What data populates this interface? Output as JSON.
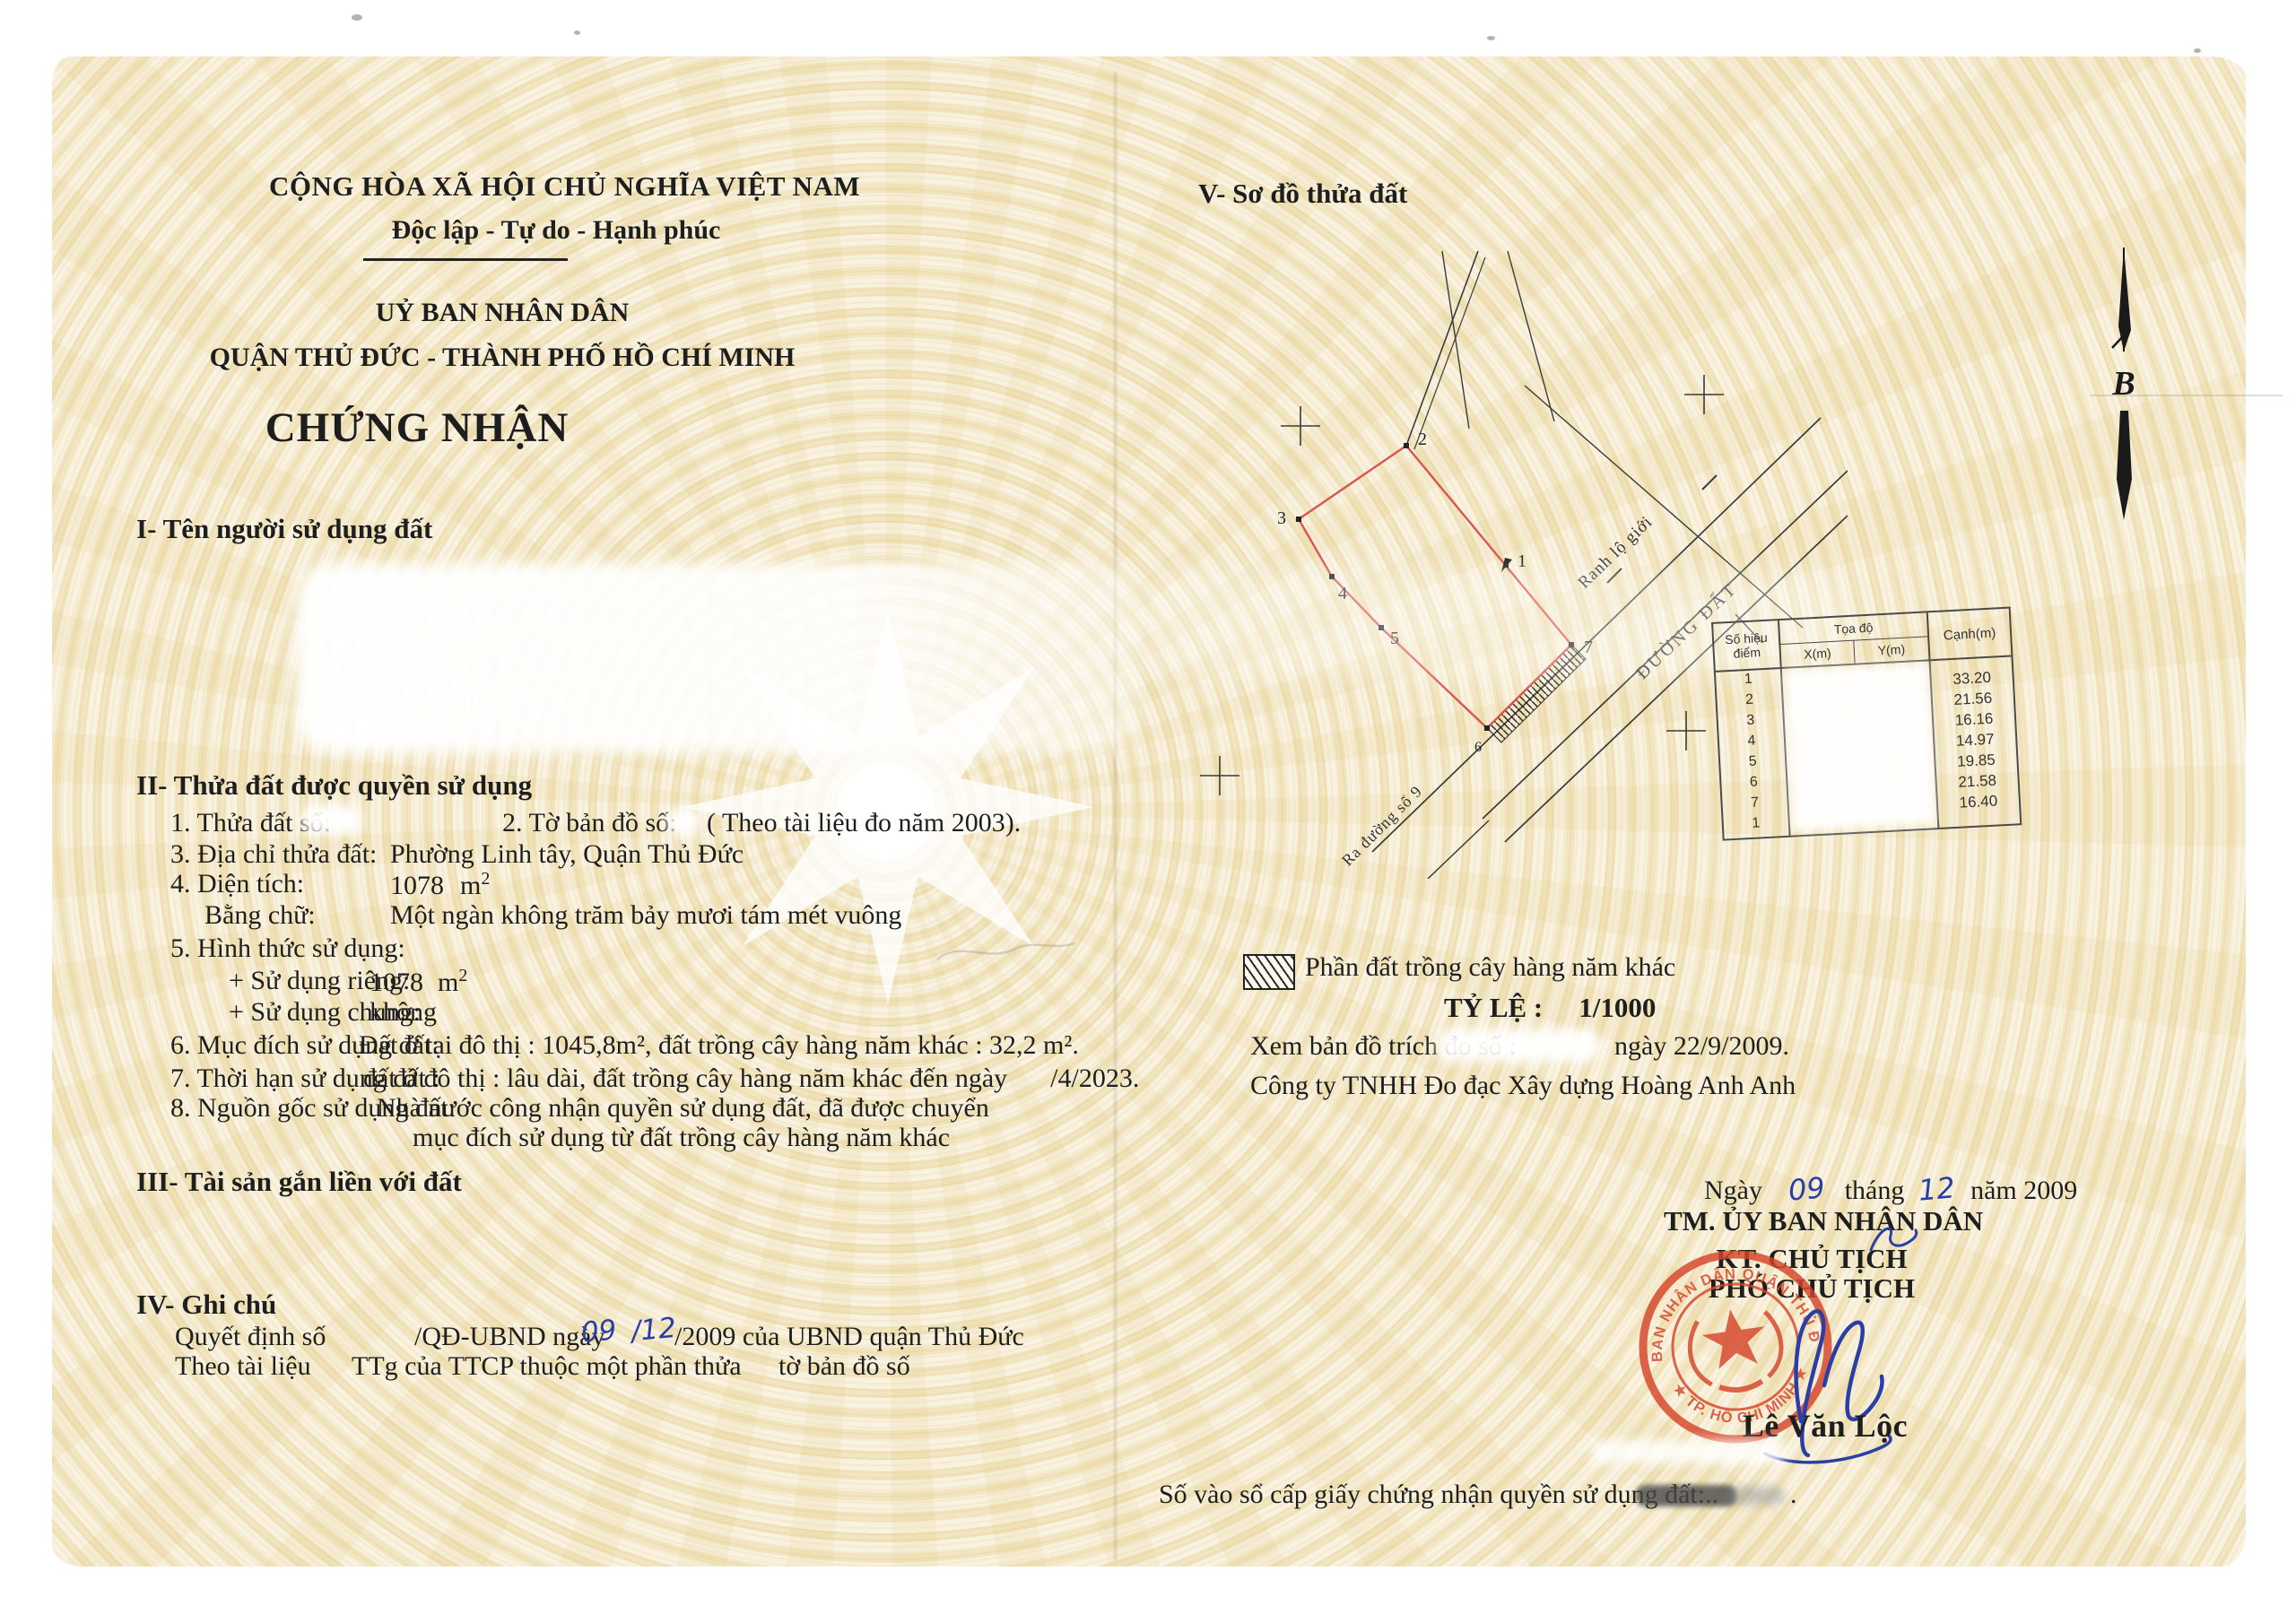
{
  "header": {
    "national_title": "CỘNG HÒA XÃ HỘI CHỦ NGHĨA VIỆT NAM",
    "motto": "Độc lập - Tự do - Hạnh phúc",
    "issuer_line1": "UỶ BAN NHÂN DÂN",
    "issuer_line2": "QUẬN THỦ ĐỨC - THÀNH PHỐ HỒ CHÍ MINH",
    "doc_title": "CHỨNG NHẬN"
  },
  "section1": {
    "heading": "I- Tên người sử dụng đất"
  },
  "section2": {
    "heading": "II- Thửa đất được quyền sử dụng",
    "item1_label": "1. Thửa đất số:",
    "item2_label": "2. Tờ bản đồ số:",
    "item2_note": "( Theo tài liệu đo năm 2003).",
    "item3_label": "3. Địa chỉ thửa đất:",
    "item3_value": "Phường Linh tây, Quận Thủ Đức",
    "item4_label": "4. Diện tích:",
    "item4_value": "1078",
    "item4_unit": "m",
    "item4_sup": "2",
    "words_label": "Bằng chữ:",
    "words_value": "Một ngàn không trăm bảy mươi tám mét vuông",
    "item5_label": "5. Hình thức sử dụng:",
    "private_label": "+ Sử dụng riêng:",
    "private_value": "1078",
    "private_unit": "m",
    "private_sup": "2",
    "shared_label": "+ Sử dụng chung:",
    "shared_value": "không",
    "item6_label": "6. Mục đích sử dụng đất:",
    "item6_value": "Đất ở tại đô thị : 1045,8m², đất trồng cây hàng năm khác : 32,2 m².",
    "item7_label": "7. Thời hạn sử dụng đất :",
    "item7_value": "đất ở đô thị : lâu dài, đất trồng cây hàng năm khác đến ngày",
    "item7_date": "/4/2023.",
    "item8_label": "8. Nguồn gốc sử dụng đất:",
    "item8_value": "Nhà nước công nhận quyền sử dụng đất, đã được chuyển",
    "item8_cont": "mục đích sử dụng từ đất trồng cây hàng năm khác"
  },
  "section3": {
    "heading": "III- Tài sản gắn liền với đất"
  },
  "section4": {
    "heading": "IV- Ghi chú",
    "line1_pre": "Quyết định số",
    "line1_mid": "/QĐ-UBND ngày",
    "line1_day": "09",
    "line1_month": "/12",
    "line1_post": "/2009 của UBND quận Thủ Đức",
    "line2_pre": "Theo tài liệu",
    "line2_mid": "TTg của TTCP thuộc một phần thửa",
    "line2_post": "tờ bản đồ số"
  },
  "section5": {
    "heading": "V- Sơ đồ thửa đất"
  },
  "diagram": {
    "road_boundary_label": "Ranh lộ giới",
    "road_label": "ĐƯỜNG ĐẤT",
    "exit_road_label": "Ra đường số 9",
    "north_label": "B",
    "vertex_labels": {
      "v1": "1",
      "v2": "2",
      "v3": "3",
      "v4": "4",
      "v5": "5",
      "v6": "6",
      "v7": "7"
    },
    "table": {
      "col_point_l1": "Số hiệu",
      "col_point_l2": "điểm",
      "col_coord": "Tọa độ",
      "col_x": "X(m)",
      "col_y": "Y(m)",
      "col_edge": "Cạnh(m)",
      "points": [
        "1",
        "2",
        "3",
        "4",
        "5",
        "6",
        "7",
        "1"
      ],
      "edges": [
        "33.20",
        "21.56",
        "16.16",
        "14.97",
        "19.85",
        "21.58",
        "16.40"
      ]
    },
    "legend_label": "Phần đất trồng cây hàng năm khác",
    "scale_label": "TỶ LỆ :",
    "scale_value": "1/1000",
    "map_ref_label": "Xem bản đồ trích đo số :",
    "map_ref_date": "ngày 22/9/2009.",
    "company": "Công ty TNHH Đo đạc Xây dựng Hoàng Anh Anh"
  },
  "signing": {
    "date_pre": "Ngày",
    "date_day": "09",
    "date_mid": "tháng",
    "date_month": "12",
    "date_post": "năm 2009",
    "authority": "TM. ỦY BAN NHÂN DÂN",
    "title1": "KT. CHỦ TỊCH",
    "title2": "PHÓ CHỦ TỊCH",
    "signer": "Lê Văn Lộc",
    "seal_text_top": "UỶ BAN NHÂN DÂN QUẬN THỦ ĐỨC",
    "seal_text_bottom": "★ TP. HỒ CHÍ MINH ★"
  },
  "footer": {
    "registry_label": "Số vào sổ cấp giấy chứng nhận quyền sử dụng đất:..",
    "registry_suffix": "."
  },
  "colors": {
    "paper": "#f7efd9",
    "pattern": "#e9d9a9",
    "ink": "#1e1e1e",
    "parcel_red": "#d85555",
    "seal_red": "#d5452a",
    "handwriting_blue": "#2b3ea6"
  }
}
